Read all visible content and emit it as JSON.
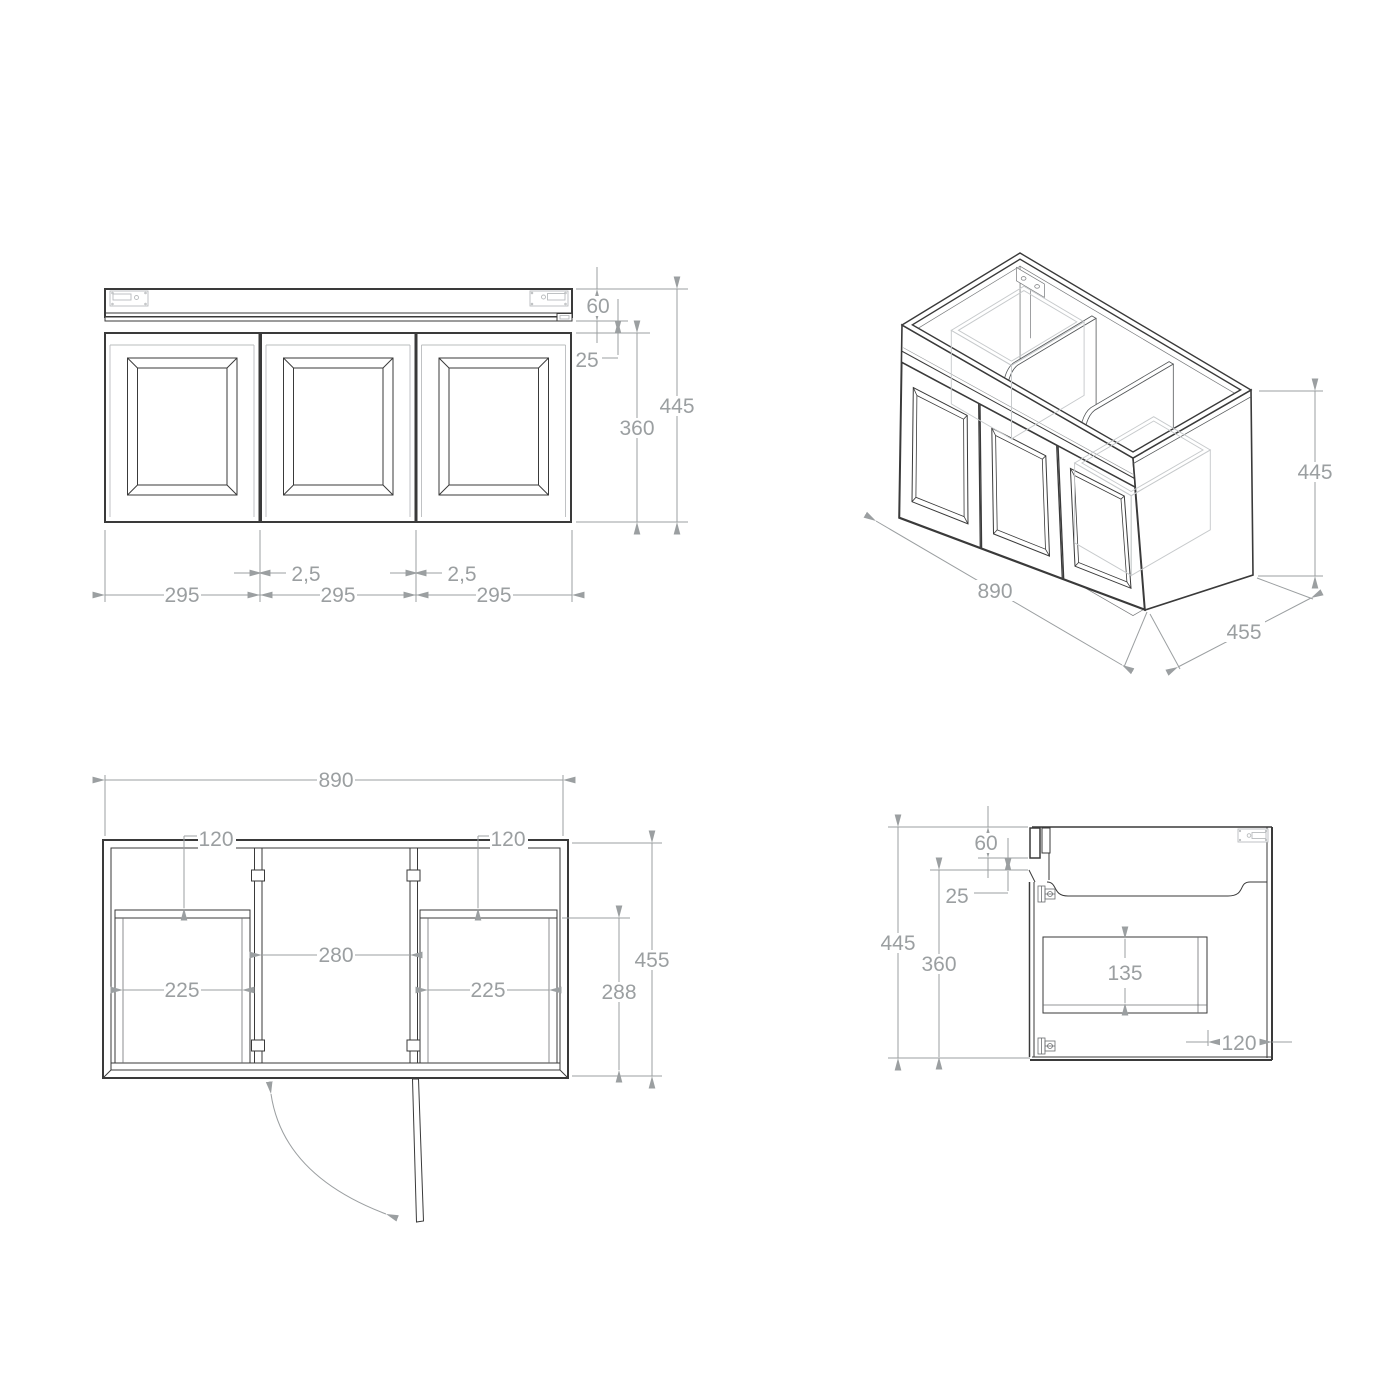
{
  "colors": {
    "line": "#3a3a3a",
    "dimension": "#9b9fa1",
    "hidden_ghost": "#c7cacc",
    "background": "#ffffff"
  },
  "views": {
    "front": {
      "labels": {
        "bench_height": "60",
        "reveal_gap": "25",
        "door_height": "360",
        "total_height": "445",
        "door1_width": "295",
        "door2_width": "295",
        "door3_width": "295",
        "gap1": "2,5",
        "gap2": "2,5"
      }
    },
    "iso": {
      "labels": {
        "width": "890",
        "depth": "455",
        "height": "445"
      }
    },
    "plan": {
      "labels": {
        "width": "890",
        "recess_left": "120",
        "recess_right": "120",
        "center_width": "280",
        "drawer_left_width": "225",
        "drawer_right_width": "225",
        "depth": "455",
        "drawer_depth": "288"
      }
    },
    "side": {
      "labels": {
        "bench_height": "60",
        "reveal_gap": "25",
        "total_height": "445",
        "door_height": "360",
        "drawer_height": "135",
        "drawer_back_offset": "120"
      }
    }
  }
}
